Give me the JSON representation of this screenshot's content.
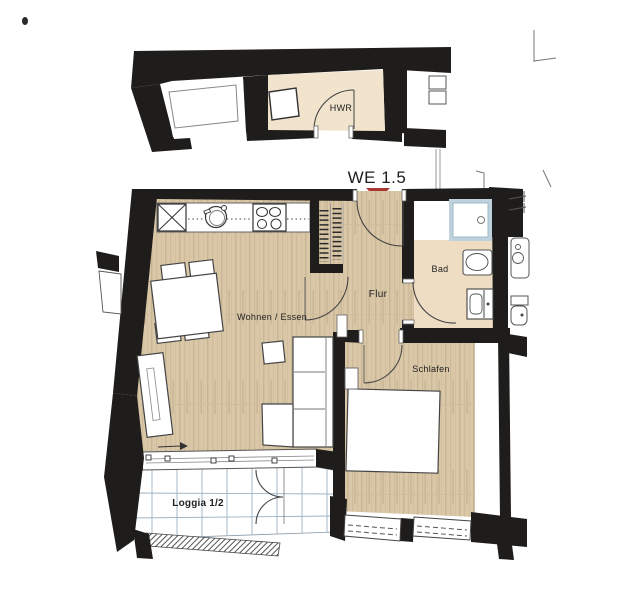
{
  "unit_marker": {
    "label": "WE 1.5",
    "triangle_color": "#a8382f"
  },
  "rooms": {
    "hwr": {
      "label": "HWR"
    },
    "wohnen": {
      "label": "Wohnen / Essen"
    },
    "flur": {
      "label": "Flur"
    },
    "bad": {
      "label": "Bad"
    },
    "schlafen": {
      "label": "Schlafen"
    },
    "loggia": {
      "label": "Loggia 1/2"
    }
  },
  "fixtures": [
    "tall-cabinet",
    "kitchen-sink",
    "cooktop",
    "wardrobe-shelves",
    "shower",
    "washbasin",
    "toilet",
    "dining-table",
    "chair",
    "sofa",
    "chaise",
    "side-table",
    "bed",
    "radiator",
    "sliding-window",
    "french-doors",
    "duct-shaft",
    "neighbor-washbasin",
    "neighbor-toilet"
  ],
  "colors": {
    "wall": "#1e1d1b",
    "wood_floor": "#d9c7a7",
    "bad_floor": "#eedcc3",
    "hwr_floor": "#f1e3cc",
    "shower_frame": "#bdd2dc",
    "loggia_grid": "#9db3c2",
    "marker_red": "#a8382f",
    "fixture_line": "#444444"
  }
}
